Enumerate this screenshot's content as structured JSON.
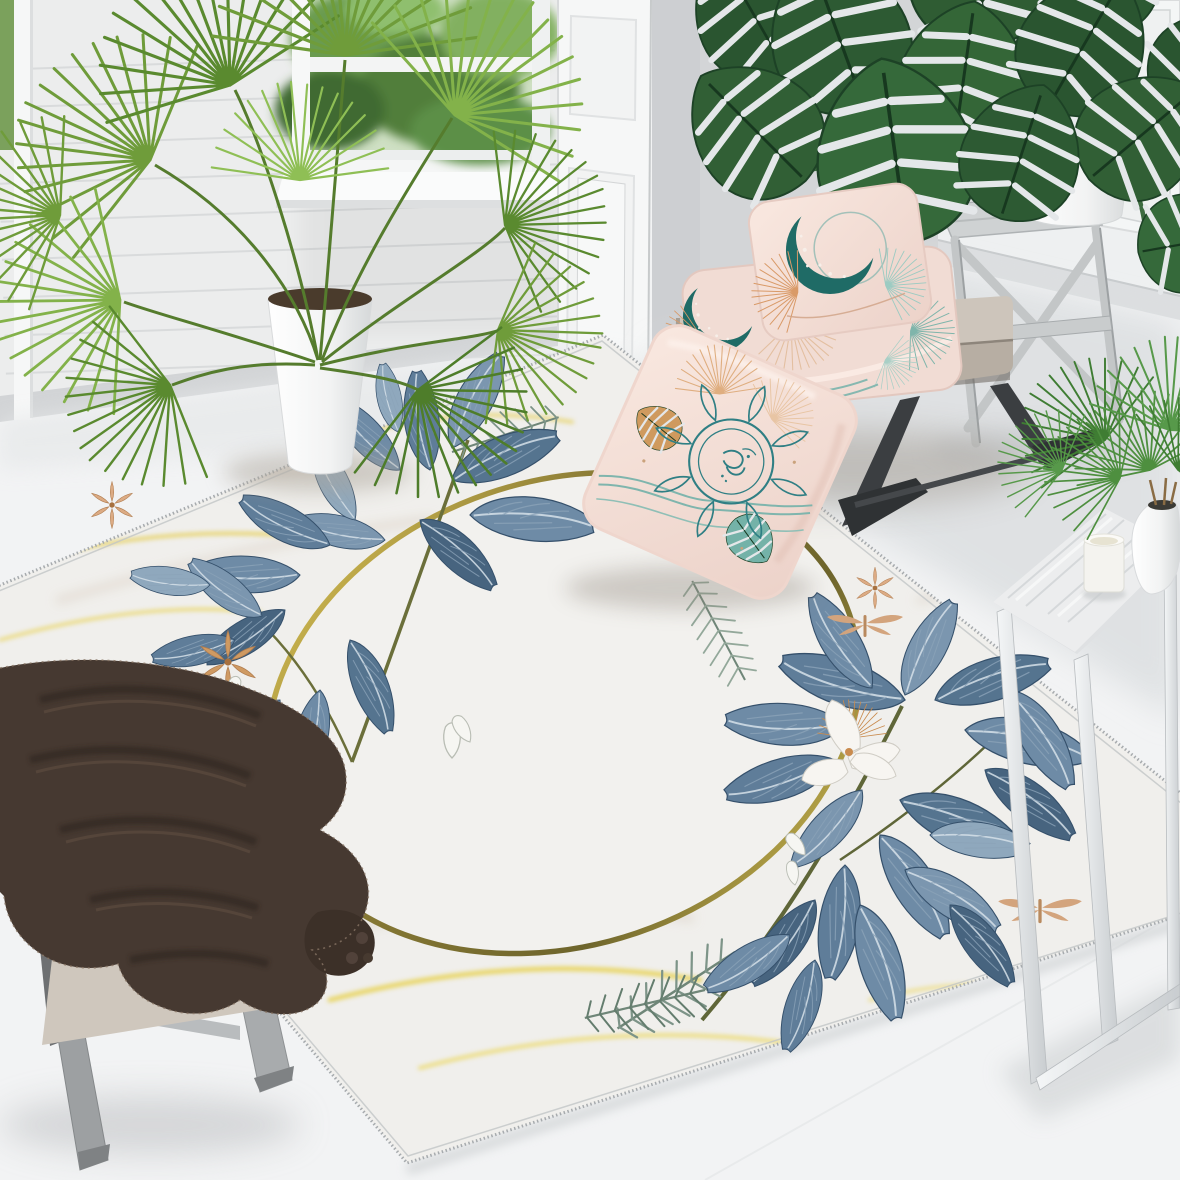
{
  "scene": {
    "description": "Bright interior product photo: white marble-pattern area rug with thin gold oval frame and blue watercolor leaf corners, styled with a fan palm, a monstera on a wooden stand, a beige bench with blush botanical-print pillows, a footstool with a dark brown fur throw, and a marble side table with a small palm and candle",
    "counts": {
      "pillows": 3,
      "plants": 3,
      "rug_motif_flowers": 5,
      "rug_motif_dragonflies": 2
    },
    "objects": {
      "window": {
        "label": "window with green garden view"
      },
      "left_wall": {
        "label": "white shiplap wall"
      },
      "pilaster": {
        "label": "white paneled pilaster"
      },
      "recess_wall": {
        "label": "gray recessed wall"
      },
      "right_wall": {
        "label": "white paneled wall with curtain"
      },
      "floor": {
        "label": "white floor"
      },
      "rug": {
        "label": "white marble-look rug with gold oval frame, blue leaves, pine sprigs and peach flowers"
      },
      "palm_plant": {
        "label": "potted fan palm in white planter"
      },
      "monstera": {
        "label": "monstera plant in white pot"
      },
      "plant_stand": {
        "label": "weathered gray folding plant stand"
      },
      "bench": {
        "label": "beige upholstered bench with dark angular metal legs"
      },
      "pillow_top": {
        "label": "blush pillow with teal crescent moon print"
      },
      "pillow_middle": {
        "label": "blush pillow with moon and botanical print"
      },
      "pillow_front": {
        "label": "blush pillow with teal mandala and leaf print leaning against bench"
      },
      "footstool": {
        "label": "beige footstool with gray wood legs"
      },
      "blanket": {
        "label": "dark brown fur throw blanket with pompom corner"
      },
      "side_table": {
        "label": "marble-top side table with white metal frame legs"
      },
      "table_plant": {
        "label": "small palm in round white vase"
      },
      "candle": {
        "label": "white candle cup"
      }
    },
    "palette": {
      "floor": "#f2f3f4",
      "left_wall": "#eceded",
      "recess_wall": "#d3d5d7",
      "right_wall": "#eef0f1",
      "rug_base": "#f0efec",
      "rug_vein_gold": "#e8d253",
      "rug_vein_beige": "#ddd3c9",
      "ring_gold_bright": "#e9d058",
      "ring_gold_olive": "#7c7030",
      "leaf_blue_mid": "#6e8ba6",
      "leaf_blue_dark": "#47647f",
      "leaf_blue_light": "#8fa8bd",
      "pine_green": "#7d9488",
      "flower_peach": "#dcab84",
      "pillow_pink": "#f5e2da",
      "print_teal": "#2f7f84",
      "print_moon_teal": "#1f6b66",
      "print_orange": "#d99a68",
      "bench_beige": "#cdc5bb",
      "bench_leg_dark": "#3b3e41",
      "blanket_brown": "#463931",
      "palm_green": "#6f9c3a",
      "monstera_green": "#2d5a33",
      "stand_gray": "#c3c6c7",
      "table_marble": "#ecedee"
    }
  }
}
